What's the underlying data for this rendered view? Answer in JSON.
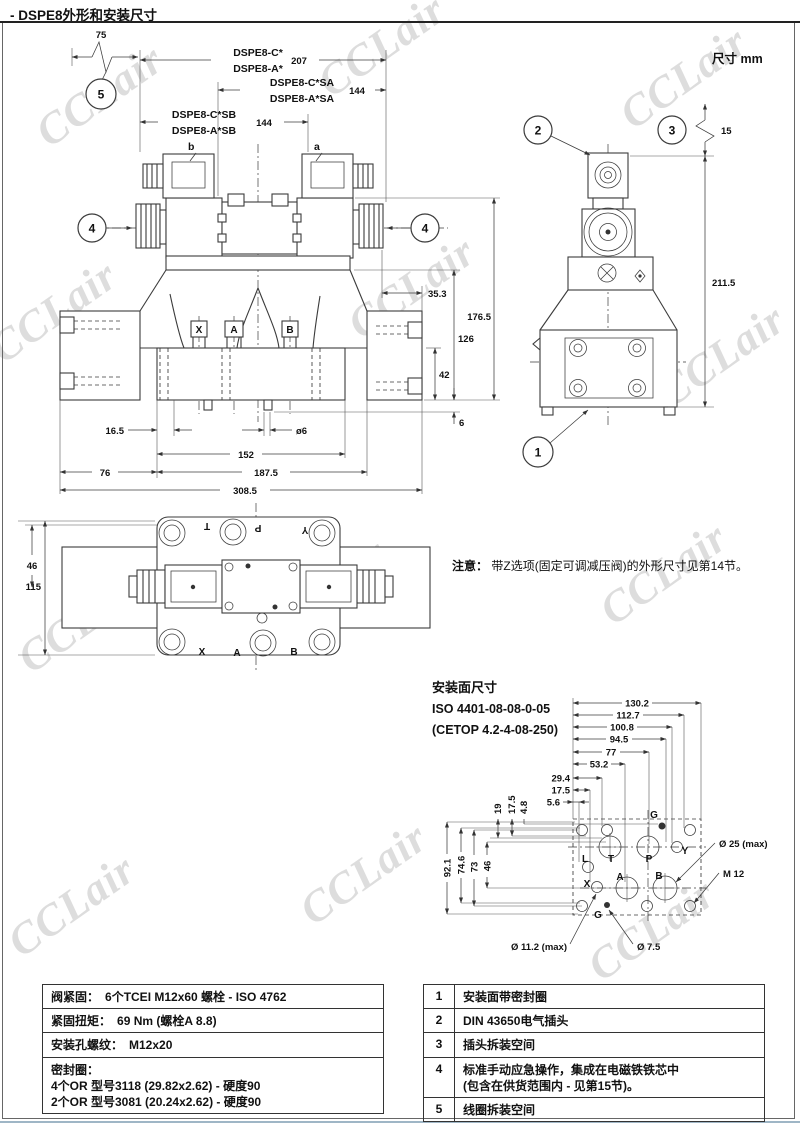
{
  "page": {
    "title": "- DSPE8外形和安装尺寸",
    "units": "尺寸  mm",
    "watermark": "CCLair"
  },
  "note": {
    "label": "注意：",
    "text": "带Z选项(固定可调减压阀)的外形尺寸见第14节。"
  },
  "front_view": {
    "dim_75": "75",
    "balloon_5": "5",
    "balloon_4": "4",
    "model_c": "DSPE8-C*",
    "model_a": "DSPE8-A*",
    "dim_207": "207",
    "model_c_sa": "DSPE8-C*SA",
    "model_a_sa": "DSPE8-A*SA",
    "dim_144_sa": "144",
    "model_c_sb": "DSPE8-C*SB",
    "model_a_sb": "DSPE8-A*SB",
    "dim_144_sb": "144",
    "coil_b": "b",
    "coil_a": "a",
    "dim_35_3": "35.3",
    "dim_176_5": "176.5",
    "dim_126": "126",
    "dim_42": "42",
    "dim_6": "6",
    "dim_16_5": "16.5",
    "dim_o6": "ø6",
    "dim_152": "152",
    "dim_76": "76",
    "dim_187_5": "187.5",
    "dim_308_5": "308.5",
    "port_x": "X",
    "port_a": "A",
    "port_b": "B"
  },
  "side_view": {
    "balloon_1": "1",
    "balloon_2": "2",
    "balloon_3": "3",
    "dim_15": "15",
    "dim_211_5": "211.5"
  },
  "top_view": {
    "dim_46": "46",
    "dim_115": "115",
    "port_t": "T",
    "port_p": "P",
    "port_y": "Y",
    "port_x": "X",
    "port_a": "A",
    "port_b": "B"
  },
  "mounting": {
    "title": "安装面尺寸",
    "iso": "ISO 4401-08-08-0-05",
    "cetop": "(CETOP 4.2-4-08-250)",
    "h_dims": [
      "130.2",
      "112.7",
      "100.8",
      "94.5",
      "77",
      "53.2",
      "29.4",
      "17.5",
      "5.6"
    ],
    "v_top": [
      "19",
      "17.5",
      "4.8"
    ],
    "v_left": [
      "92.1",
      "74.6",
      "73",
      "46"
    ],
    "ports": {
      "g_top": "G",
      "l": "L",
      "t": "T",
      "p": "P",
      "y": "Y",
      "x": "X",
      "a": "A",
      "b": "B",
      "g_bottom": "G"
    },
    "callout_d25": "Ø 25 (max)",
    "callout_m12": "M 12",
    "callout_d11": "Ø 11.2 (max)",
    "callout_d75": "Ø 7.5"
  },
  "spec_table": {
    "rows": [
      {
        "label": "阀紧固：",
        "value": "6个TCEI M12x60 螺栓 - ISO 4762"
      },
      {
        "label": "紧固扭矩：",
        "value": "69 Nm (螺栓A 8.8)"
      },
      {
        "label": "安装孔螺纹：",
        "value": "M12x20"
      },
      {
        "label": "密封圈：",
        "line1": "4个OR 型号3118 (29.82x2.62) - 硬度90",
        "line2": "2个OR 型号3081 (20.24x2.62) - 硬度90"
      }
    ]
  },
  "legend_table": {
    "rows": [
      {
        "num": "1",
        "text": "安装面带密封圈"
      },
      {
        "num": "2",
        "text": "DIN 43650电气插头"
      },
      {
        "num": "3",
        "text": "插头拆装空间"
      },
      {
        "num": "4",
        "text": "标准手动应急操作，集成在电磁铁铁芯中",
        "text2": "(包含在供货范围内 - 见第15节)。"
      },
      {
        "num": "5",
        "text": "线圈拆装空间"
      }
    ]
  }
}
